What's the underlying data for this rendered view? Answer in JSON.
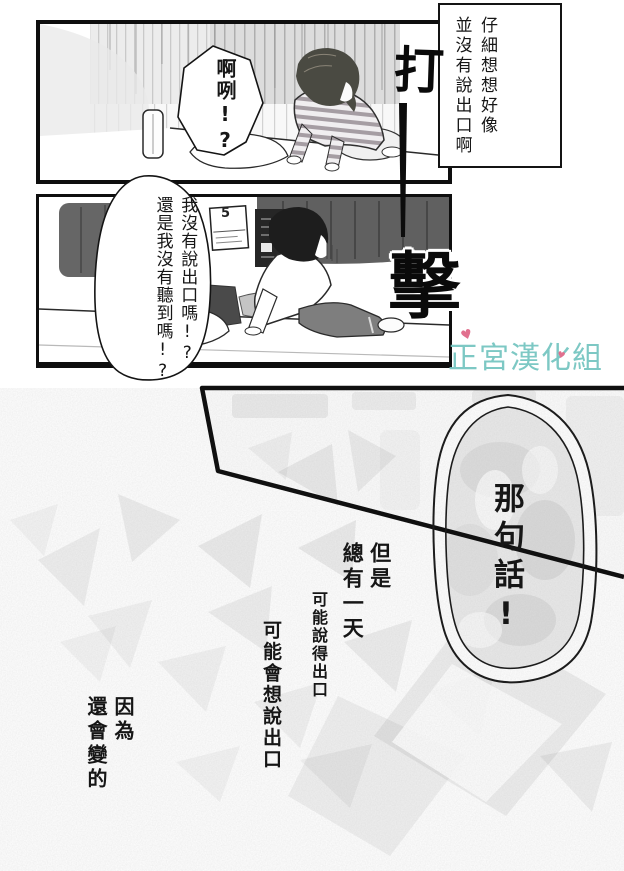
{
  "caption": {
    "col1": "仔細想想好像",
    "col2": "並沒有說出口啊"
  },
  "panel1": {
    "bubble": "啊咧!?"
  },
  "panel2": {
    "bubble_col1": "我沒有說出口嗎!?",
    "bubble_col2": "還是我沒有聽到嗎!?",
    "calendar_day": "5"
  },
  "bubble3": {
    "text": "那句話!"
  },
  "sfx": {
    "top": "打",
    "bottom": "擊"
  },
  "narration": {
    "col1": "但是",
    "col2": "總有一天",
    "line2": "可能說得出口",
    "line3": "可能會想說出口",
    "col3": "因為",
    "col4": "還會變的"
  },
  "watermark": {
    "text": "正宮漢化組",
    "heart": "♥",
    "text_color": "#72c4bf",
    "heart_color": "#e1708e"
  }
}
